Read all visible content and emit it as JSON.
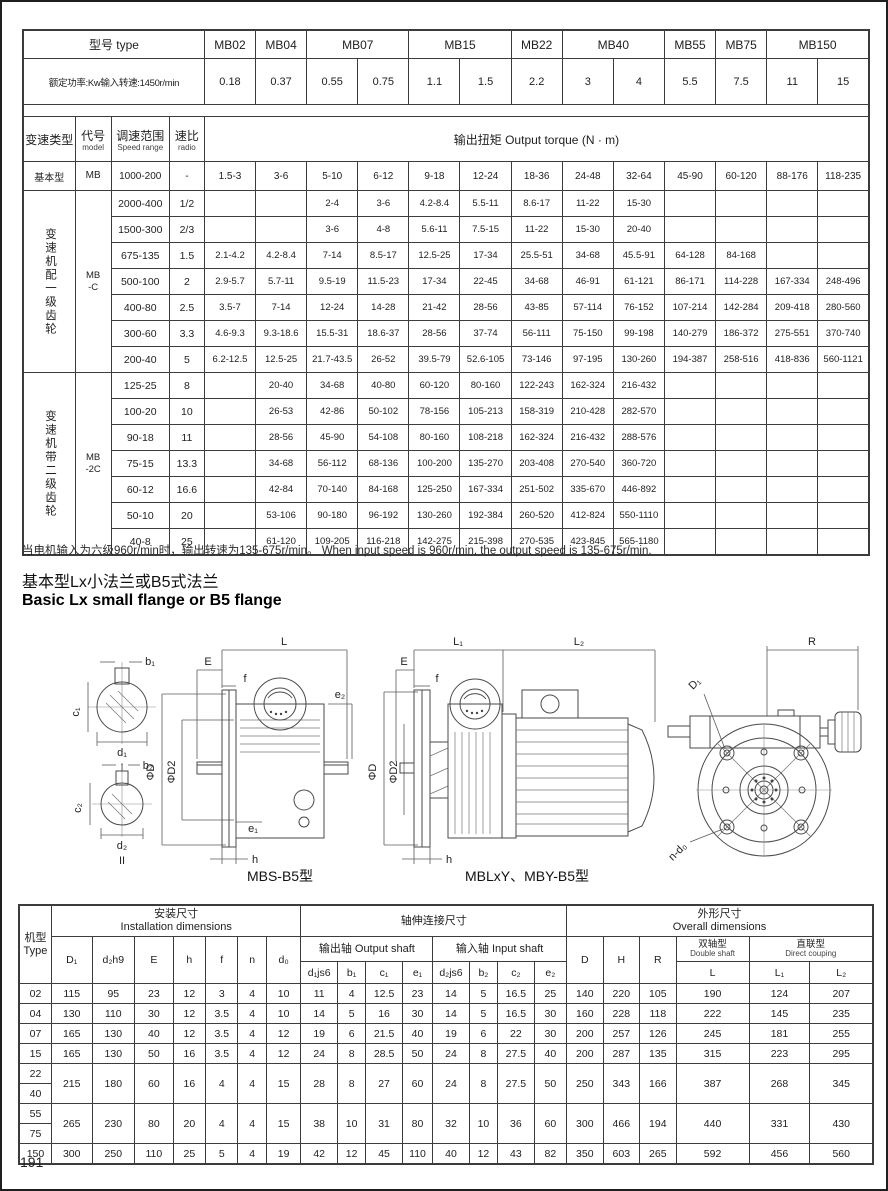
{
  "page_number": "191",
  "top_table": {
    "header": {
      "type_label": "型号 type",
      "models": [
        "MB02",
        "MB04",
        "MB07",
        "MB15",
        "MB22",
        "MB40",
        "MB55",
        "MB75",
        "MB150"
      ],
      "power_label": "额定功率:Kw输入转速:1450r/min",
      "powers": [
        "0.18",
        "0.37",
        "0.55",
        "0.75",
        "1.1",
        "1.5",
        "2.2",
        "3",
        "4",
        "5.5",
        "7.5",
        "11",
        "15"
      ],
      "type_col": "变速类型",
      "code_col_cn": "代号",
      "code_col_en": "model",
      "range_col_cn": "调速范围",
      "range_col_en": "Speed range",
      "ratio_col_cn": "速比",
      "ratio_col_en": "radio",
      "torque_label": "输出扭矩 Output torque (N · m)"
    },
    "sections": [
      {
        "label": "基本型",
        "code": "MB",
        "vertical": false,
        "rows": [
          {
            "range": "1000-200",
            "ratio": "-",
            "values": [
              "1.5-3",
              "3-6",
              "5-10",
              "6-12",
              "9-18",
              "12-24",
              "18-36",
              "24-48",
              "32-64",
              "45-90",
              "60-120",
              "88-176",
              "118-235"
            ]
          }
        ]
      },
      {
        "label": "变速机配一级齿轮",
        "code": "MB\n-C",
        "vertical": true,
        "rows": [
          {
            "range": "2000-400",
            "ratio": "1/2",
            "values": [
              "",
              "",
              "2-4",
              "3-6",
              "4.2-8.4",
              "5.5-11",
              "8.6-17",
              "11-22",
              "15-30",
              "",
              "",
              "",
              ""
            ]
          },
          {
            "range": "1500-300",
            "ratio": "2/3",
            "values": [
              "",
              "",
              "3-6",
              "4-8",
              "5.6-11",
              "7.5-15",
              "11-22",
              "15-30",
              "20-40",
              "",
              "",
              "",
              ""
            ]
          },
          {
            "range": "675-135",
            "ratio": "1.5",
            "values": [
              "2.1-4.2",
              "4.2-8.4",
              "7-14",
              "8.5-17",
              "12.5-25",
              "17-34",
              "25.5-51",
              "34-68",
              "45.5-91",
              "64-128",
              "84-168",
              "",
              ""
            ]
          },
          {
            "range": "500-100",
            "ratio": "2",
            "values": [
              "2.9-5.7",
              "5.7-11",
              "9.5-19",
              "11.5-23",
              "17-34",
              "22-45",
              "34-68",
              "46-91",
              "61-121",
              "86-171",
              "114-228",
              "167-334",
              "248-496"
            ]
          },
          {
            "range": "400-80",
            "ratio": "2.5",
            "values": [
              "3.5-7",
              "7-14",
              "12-24",
              "14-28",
              "21-42",
              "28-56",
              "43-85",
              "57-114",
              "76-152",
              "107-214",
              "142-284",
              "209-418",
              "280-560"
            ]
          },
          {
            "range": "300-60",
            "ratio": "3.3",
            "values": [
              "4.6-9.3",
              "9.3-18.6",
              "15.5-31",
              "18.6-37",
              "28-56",
              "37-74",
              "56-111",
              "75-150",
              "99-198",
              "140-279",
              "186-372",
              "275-551",
              "370-740"
            ]
          },
          {
            "range": "200-40",
            "ratio": "5",
            "values": [
              "6.2-12.5",
              "12.5-25",
              "21.7-43.5",
              "26-52",
              "39.5-79",
              "52.6-105",
              "73-146",
              "97-195",
              "130-260",
              "194-387",
              "258-516",
              "418-836",
              "560-1121"
            ]
          }
        ]
      },
      {
        "label": "变速机带二级齿轮",
        "code": "MB\n-2C",
        "vertical": true,
        "rows": [
          {
            "range": "125-25",
            "ratio": "8",
            "values": [
              "",
              "20-40",
              "34-68",
              "40-80",
              "60-120",
              "80-160",
              "122-243",
              "162-324",
              "216-432",
              "",
              "",
              "",
              ""
            ]
          },
          {
            "range": "100-20",
            "ratio": "10",
            "values": [
              "",
              "26-53",
              "42-86",
              "50-102",
              "78-156",
              "105-213",
              "158-319",
              "210-428",
              "282-570",
              "",
              "",
              "",
              ""
            ]
          },
          {
            "range": "90-18",
            "ratio": "11",
            "values": [
              "",
              "28-56",
              "45-90",
              "54-108",
              "80-160",
              "108-218",
              "162-324",
              "216-432",
              "288-576",
              "",
              "",
              "",
              ""
            ]
          },
          {
            "range": "75-15",
            "ratio": "13.3",
            "values": [
              "",
              "34-68",
              "56-112",
              "68-136",
              "100-200",
              "135-270",
              "203-408",
              "270-540",
              "360-720",
              "",
              "",
              "",
              ""
            ]
          },
          {
            "range": "60-12",
            "ratio": "16.6",
            "values": [
              "",
              "42-84",
              "70-140",
              "84-168",
              "125-250",
              "167-334",
              "251-502",
              "335-670",
              "446-892",
              "",
              "",
              "",
              ""
            ]
          },
          {
            "range": "50-10",
            "ratio": "20",
            "values": [
              "",
              "53-106",
              "90-180",
              "96-192",
              "130-260",
              "192-384",
              "260-520",
              "412-824",
              "550-1110",
              "",
              "",
              "",
              ""
            ]
          },
          {
            "range": "40-8",
            "ratio": "25",
            "values": [
              "",
              "61-120",
              "109-205",
              "116-218",
              "142-275",
              "215-398",
              "270-535",
              "423-845",
              "565-1180",
              "",
              "",
              "",
              ""
            ]
          }
        ]
      }
    ]
  },
  "note": "当电机输入为六级960r/min时，输出转速为135-675r/min。 When input speed is 960r/min, the output speed is 135-675r/min.",
  "heading_cn": "基本型Lx小法兰或B5式法兰",
  "heading_en": "Basic Lx small flange or B5 flange",
  "drawings": {
    "caption_1": "MBS-B5型",
    "caption_2": "MBLxY、MBY-B5型",
    "labels": {
      "b1": "b₁",
      "c1": "c₁",
      "d1": "d₁",
      "sec1": "I",
      "b2": "b₂",
      "c2": "c₂",
      "d2": "d₂",
      "sec2": "II",
      "L": "L",
      "E1": "E",
      "f1": "f",
      "phiD_1": "ΦD",
      "phiD2_1": "ΦD2",
      "e1": "e₁",
      "e2": "e₂",
      "h1": "h",
      "L1": "L₁",
      "L2": "L₂",
      "E2": "E",
      "f2": "f",
      "phiD_2": "ΦD",
      "phiD2_2": "ΦD2",
      "h2": "h",
      "R": "R",
      "D1": "D₁",
      "nd0": "n-d₀"
    }
  },
  "bottom_table": {
    "header": {
      "type_label": "机型\nType",
      "install_cn": "安装尺寸",
      "install_en": "Installation dimensions",
      "shaft_cn": "轴伸连接尺寸",
      "output_cn": "输出轴 Output shaft",
      "input_cn": "输入轴 Input shaft",
      "overall_cn": "外形尺寸",
      "overall_en": "Overall dimensions",
      "double_cn": "双轴型",
      "double_en": "Double shaft",
      "direct_cn": "直联型",
      "direct_en": "Direct couping",
      "install_cols": [
        "D₁",
        "d₂h9",
        "E",
        "h",
        "f",
        "n",
        "d₀"
      ],
      "output_cols": [
        "d₁js6",
        "b₁",
        "c₁",
        "e₁"
      ],
      "input_cols": [
        "d₂js6",
        "b₂",
        "c₂",
        "e₂"
      ],
      "overall_cols": [
        "D",
        "H",
        "R"
      ],
      "L_col": "L",
      "L1_col": "L₁",
      "L2_col": "L₂"
    },
    "rows": [
      {
        "types": [
          "02"
        ],
        "values": [
          "115",
          "95",
          "23",
          "12",
          "3",
          "4",
          "10",
          "11",
          "4",
          "12.5",
          "23",
          "14",
          "5",
          "16.5",
          "25",
          "140",
          "220",
          "105",
          "190",
          "124",
          "207"
        ]
      },
      {
        "types": [
          "04"
        ],
        "values": [
          "130",
          "110",
          "30",
          "12",
          "3.5",
          "4",
          "10",
          "14",
          "5",
          "16",
          "30",
          "14",
          "5",
          "16.5",
          "30",
          "160",
          "228",
          "118",
          "222",
          "145",
          "235"
        ]
      },
      {
        "types": [
          "07"
        ],
        "values": [
          "165",
          "130",
          "40",
          "12",
          "3.5",
          "4",
          "12",
          "19",
          "6",
          "21.5",
          "40",
          "19",
          "6",
          "22",
          "30",
          "200",
          "257",
          "126",
          "245",
          "181",
          "255"
        ]
      },
      {
        "types": [
          "15"
        ],
        "values": [
          "165",
          "130",
          "50",
          "16",
          "3.5",
          "4",
          "12",
          "24",
          "8",
          "28.5",
          "50",
          "24",
          "8",
          "27.5",
          "40",
          "200",
          "287",
          "135",
          "315",
          "223",
          "295"
        ]
      },
      {
        "types": [
          "22",
          "40"
        ],
        "values": [
          "215",
          "180",
          "60",
          "16",
          "4",
          "4",
          "15",
          "28",
          "8",
          "27",
          "60",
          "24",
          "8",
          "27.5",
          "50",
          "250",
          "343",
          "166",
          "387",
          "268",
          "345"
        ]
      },
      {
        "types": [
          "55",
          "75"
        ],
        "values": [
          "265",
          "230",
          "80",
          "20",
          "4",
          "4",
          "15",
          "38",
          "10",
          "31",
          "80",
          "32",
          "10",
          "36",
          "60",
          "300",
          "466",
          "194",
          "440",
          "331",
          "430"
        ]
      },
      {
        "types": [
          "150"
        ],
        "values": [
          "300",
          "250",
          "110",
          "25",
          "5",
          "4",
          "19",
          "42",
          "12",
          "45",
          "110",
          "40",
          "12",
          "43",
          "82",
          "350",
          "603",
          "265",
          "592",
          "456",
          "560"
        ]
      }
    ]
  }
}
